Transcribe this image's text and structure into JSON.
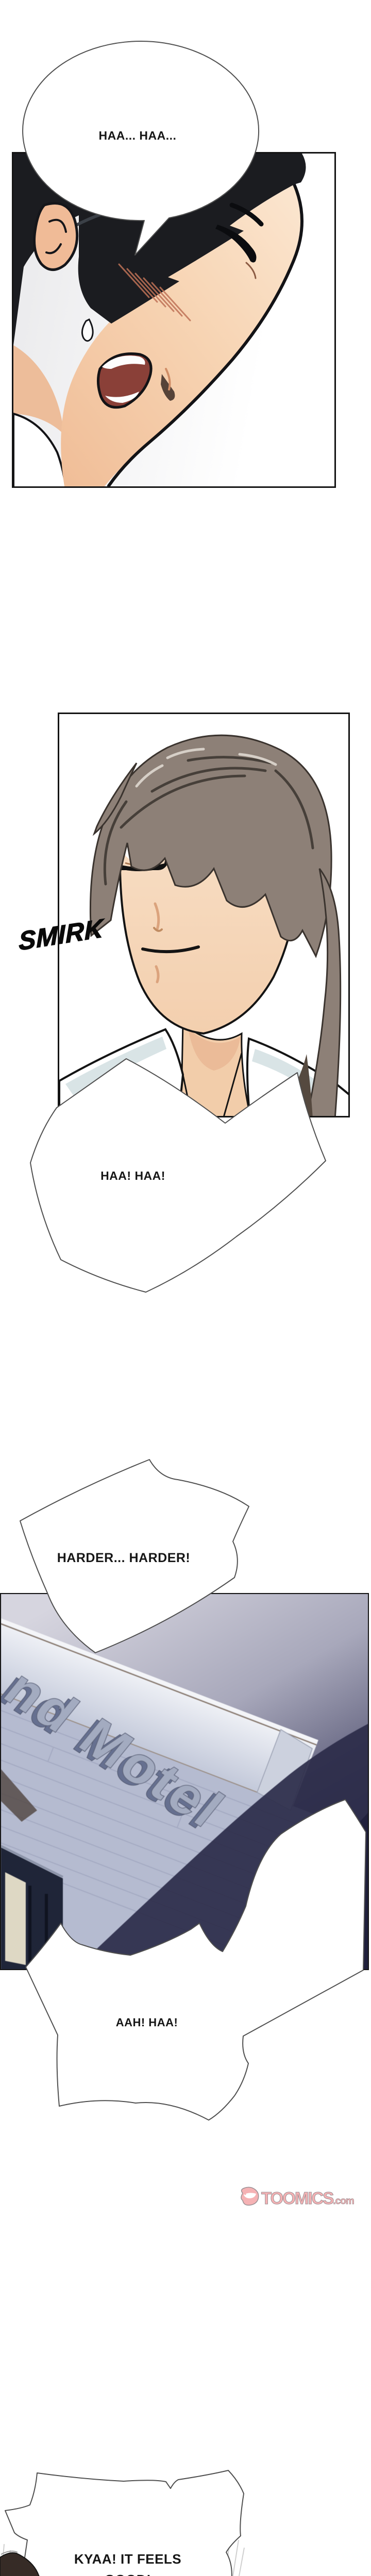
{
  "speech": {
    "panting_top": "HAA... HAA...",
    "panting_glasses": "HAA! HAA!",
    "harder": "HARDER... HARDER!",
    "aah": "AAH! HAA!",
    "kyaa_line1": "KYAA! IT FEELS",
    "kyaa_line2": "GOOD!"
  },
  "sfx": {
    "smirk": "SMIRK"
  },
  "scene": {
    "motel_sign_text": "nd Motel"
  },
  "watermark": {
    "brand": "TOOMICS",
    "suffix": ".com"
  },
  "colors": {
    "panel_border": "#141414",
    "bubble_outline": "#4f4f4f",
    "hair_black": "#1b1c20",
    "hair_gray_brown": "#8d8077",
    "skin_light": "#f8e0c8",
    "skin_tan": "#f2c29c",
    "sign_letters": "#a3abc0",
    "night_navy": "#23233e",
    "watermark_pink": "#f5b2b4"
  }
}
